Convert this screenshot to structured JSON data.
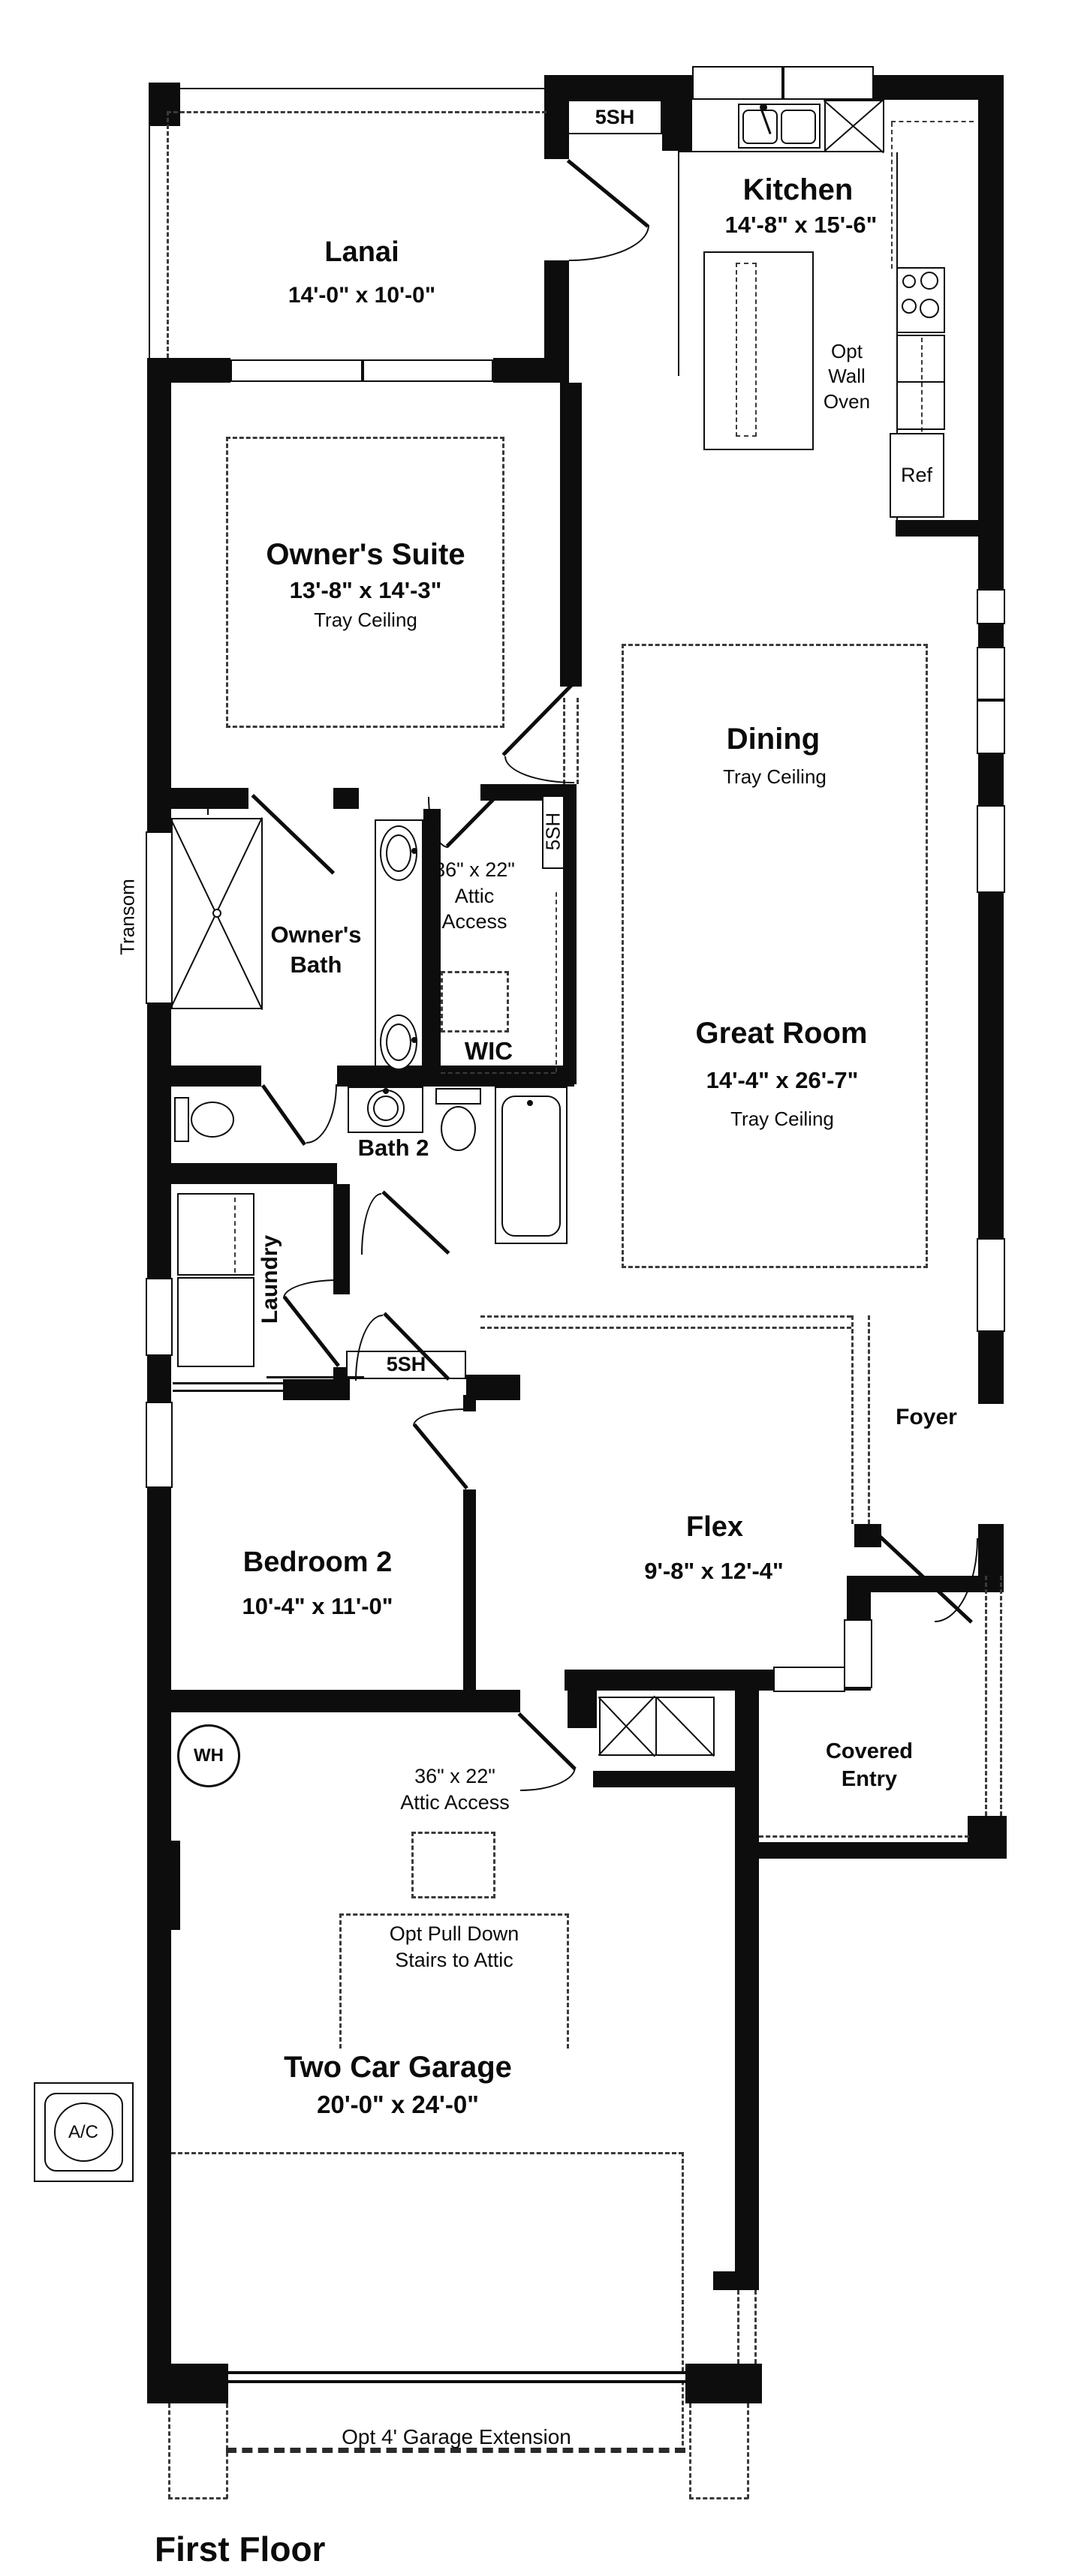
{
  "title": "First Floor",
  "rooms": {
    "lanai": {
      "name": "Lanai",
      "dims": "14'-0\" x 10'-0\""
    },
    "kitchen": {
      "name": "Kitchen",
      "dims": "14'-8\" x 15'-6\""
    },
    "owners_suite": {
      "name": "Owner's Suite",
      "dims": "13'-8\" x 14'-3\"",
      "ceiling": "Tray Ceiling"
    },
    "dining": {
      "name": "Dining",
      "ceiling": "Tray Ceiling"
    },
    "great_room": {
      "name": "Great Room",
      "dims": "14'-4\" x 26'-7\"",
      "ceiling": "Tray Ceiling"
    },
    "owners_bath": {
      "name": "Owner's\nBath"
    },
    "wic": {
      "name": "WIC"
    },
    "bath2": {
      "name": "Bath 2"
    },
    "laundry": {
      "name": "Laundry"
    },
    "bedroom2": {
      "name": "Bedroom 2",
      "dims": "10'-4\" x 11'-0\""
    },
    "flex": {
      "name": "Flex",
      "dims": "9'-8\" x 12'-4\""
    },
    "foyer": {
      "name": "Foyer"
    },
    "covered_entry": {
      "name": "Covered\nEntry"
    },
    "garage": {
      "name": "Two Car Garage",
      "dims": "20'-0\" x 24'-0\""
    }
  },
  "annotations": {
    "attic_access_wic": "36\" x 22\"\nAttic\nAccess",
    "attic_access_garage": "36\" x 22\"\nAttic Access",
    "pull_down_stairs": "Opt Pull Down\nStairs to Attic",
    "opt_wall_oven": "Opt\nWall\nOven",
    "ref": "Ref",
    "wh": "WH",
    "ac": "A/C",
    "transom": "Transom",
    "window_5sh": "5SH",
    "garage_extension": "Opt 4' Garage Extension"
  },
  "colors": {
    "wall": "#0d0d0d",
    "dash": "#3a3a3a",
    "background": "#ffffff",
    "text": "#0b0b0b"
  }
}
